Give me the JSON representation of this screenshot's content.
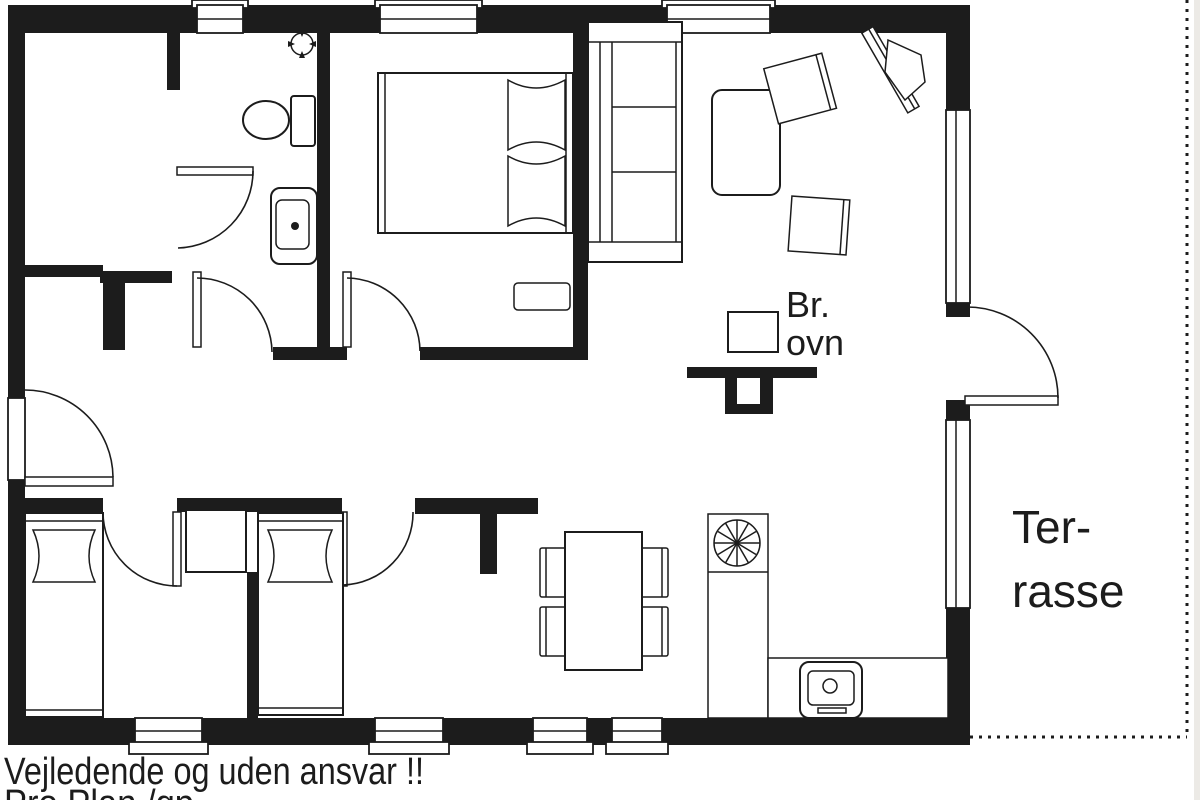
{
  "labels": {
    "stove_line1": "Br.",
    "stove_line2": "ovn",
    "terrace_line1": "Ter-",
    "terrace_line2": "rasse",
    "disclaimer": "Vejledende og uden ansvar !!",
    "credit": "Pro Plan /gp"
  },
  "colors": {
    "ink": "#1c1c1c",
    "paper": "#ffffff"
  },
  "icons": {
    "toilet": "toilet-top-view",
    "sink_vanity": "bathroom-sink-top-view",
    "ceiling_fan": "vent-symbol",
    "double_bed": "double-bed-top-view",
    "single_bed": "single-bed-top-view",
    "sofa": "three-seat-sofa-top-view",
    "armchair": "armchair-top-view",
    "tv_bench": "angled-tv-bench",
    "coffee_table": "coffee-table",
    "dining_table": "dining-table-four-chairs",
    "hob": "cooktop-burner-symbol",
    "kitchen_sink": "kitchen-sink-top-view",
    "wood_stove": "wood-burning-stove-symbol",
    "door": "door-swing-symbol",
    "window": "window-symbol"
  }
}
